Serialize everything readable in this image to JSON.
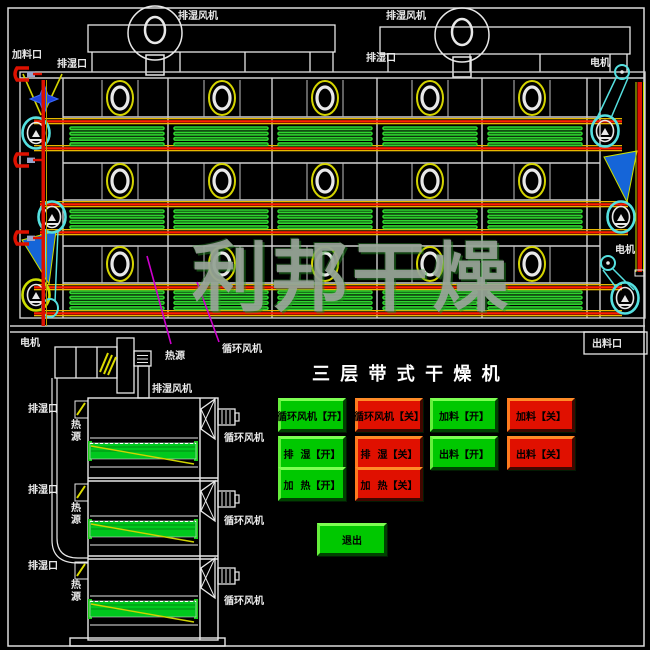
{
  "watermark": "利邦干燥",
  "machine": {
    "feed_port": "加料口",
    "vent_port_left": "排湿口",
    "vent_port_mid": "排湿口",
    "vent_fan_left": "排湿风机",
    "vent_fan_right": "排湿风机",
    "motor_top_right": "电机",
    "motor_mid_right": "电机",
    "motor_bottom_left": "电机",
    "discharge_port": "出料口",
    "pointer_heat_source": "热源",
    "pointer_circulation_fan": "循环风机"
  },
  "side_view": {
    "motor": "电机",
    "vent_fan": "排湿风机",
    "sections": [
      {
        "vent_port": "排湿口",
        "heat_source": "热源",
        "circulation_fan": "循环风机"
      },
      {
        "vent_port": "排湿口",
        "heat_source": "热源",
        "circulation_fan": "循环风机"
      },
      {
        "vent_port": "排湿口",
        "heat_source": "热源",
        "circulation_fan": "循环风机"
      }
    ]
  },
  "panel": {
    "title": "三 层 带 式 干 燥 机",
    "buttons": [
      {
        "label": "循环风机【开】",
        "state": "on"
      },
      {
        "label": "循环风机【关】",
        "state": "off"
      },
      {
        "label": "加料【开】",
        "state": "on"
      },
      {
        "label": "加料【关】",
        "state": "off"
      },
      {
        "label": "排  湿【开】",
        "state": "on"
      },
      {
        "label": "排  湿【关】",
        "state": "off"
      },
      {
        "label": "出料【开】",
        "state": "on"
      },
      {
        "label": "出料【关】",
        "state": "off"
      },
      {
        "label": "加  热【开】",
        "state": "on"
      },
      {
        "label": "加  热【关】",
        "state": "off"
      }
    ],
    "exit_label": "退出"
  },
  "colors": {
    "on_button": "#00c800",
    "off_button": "#e01000",
    "belt_red": "#ff1e00",
    "belt_yellow": "#e8b800",
    "slat_green": "#2fd32f",
    "pulley_cyan": "#55e0e0",
    "chute_blue": "#1565d8",
    "pointer_magenta": "#cc00cc"
  }
}
